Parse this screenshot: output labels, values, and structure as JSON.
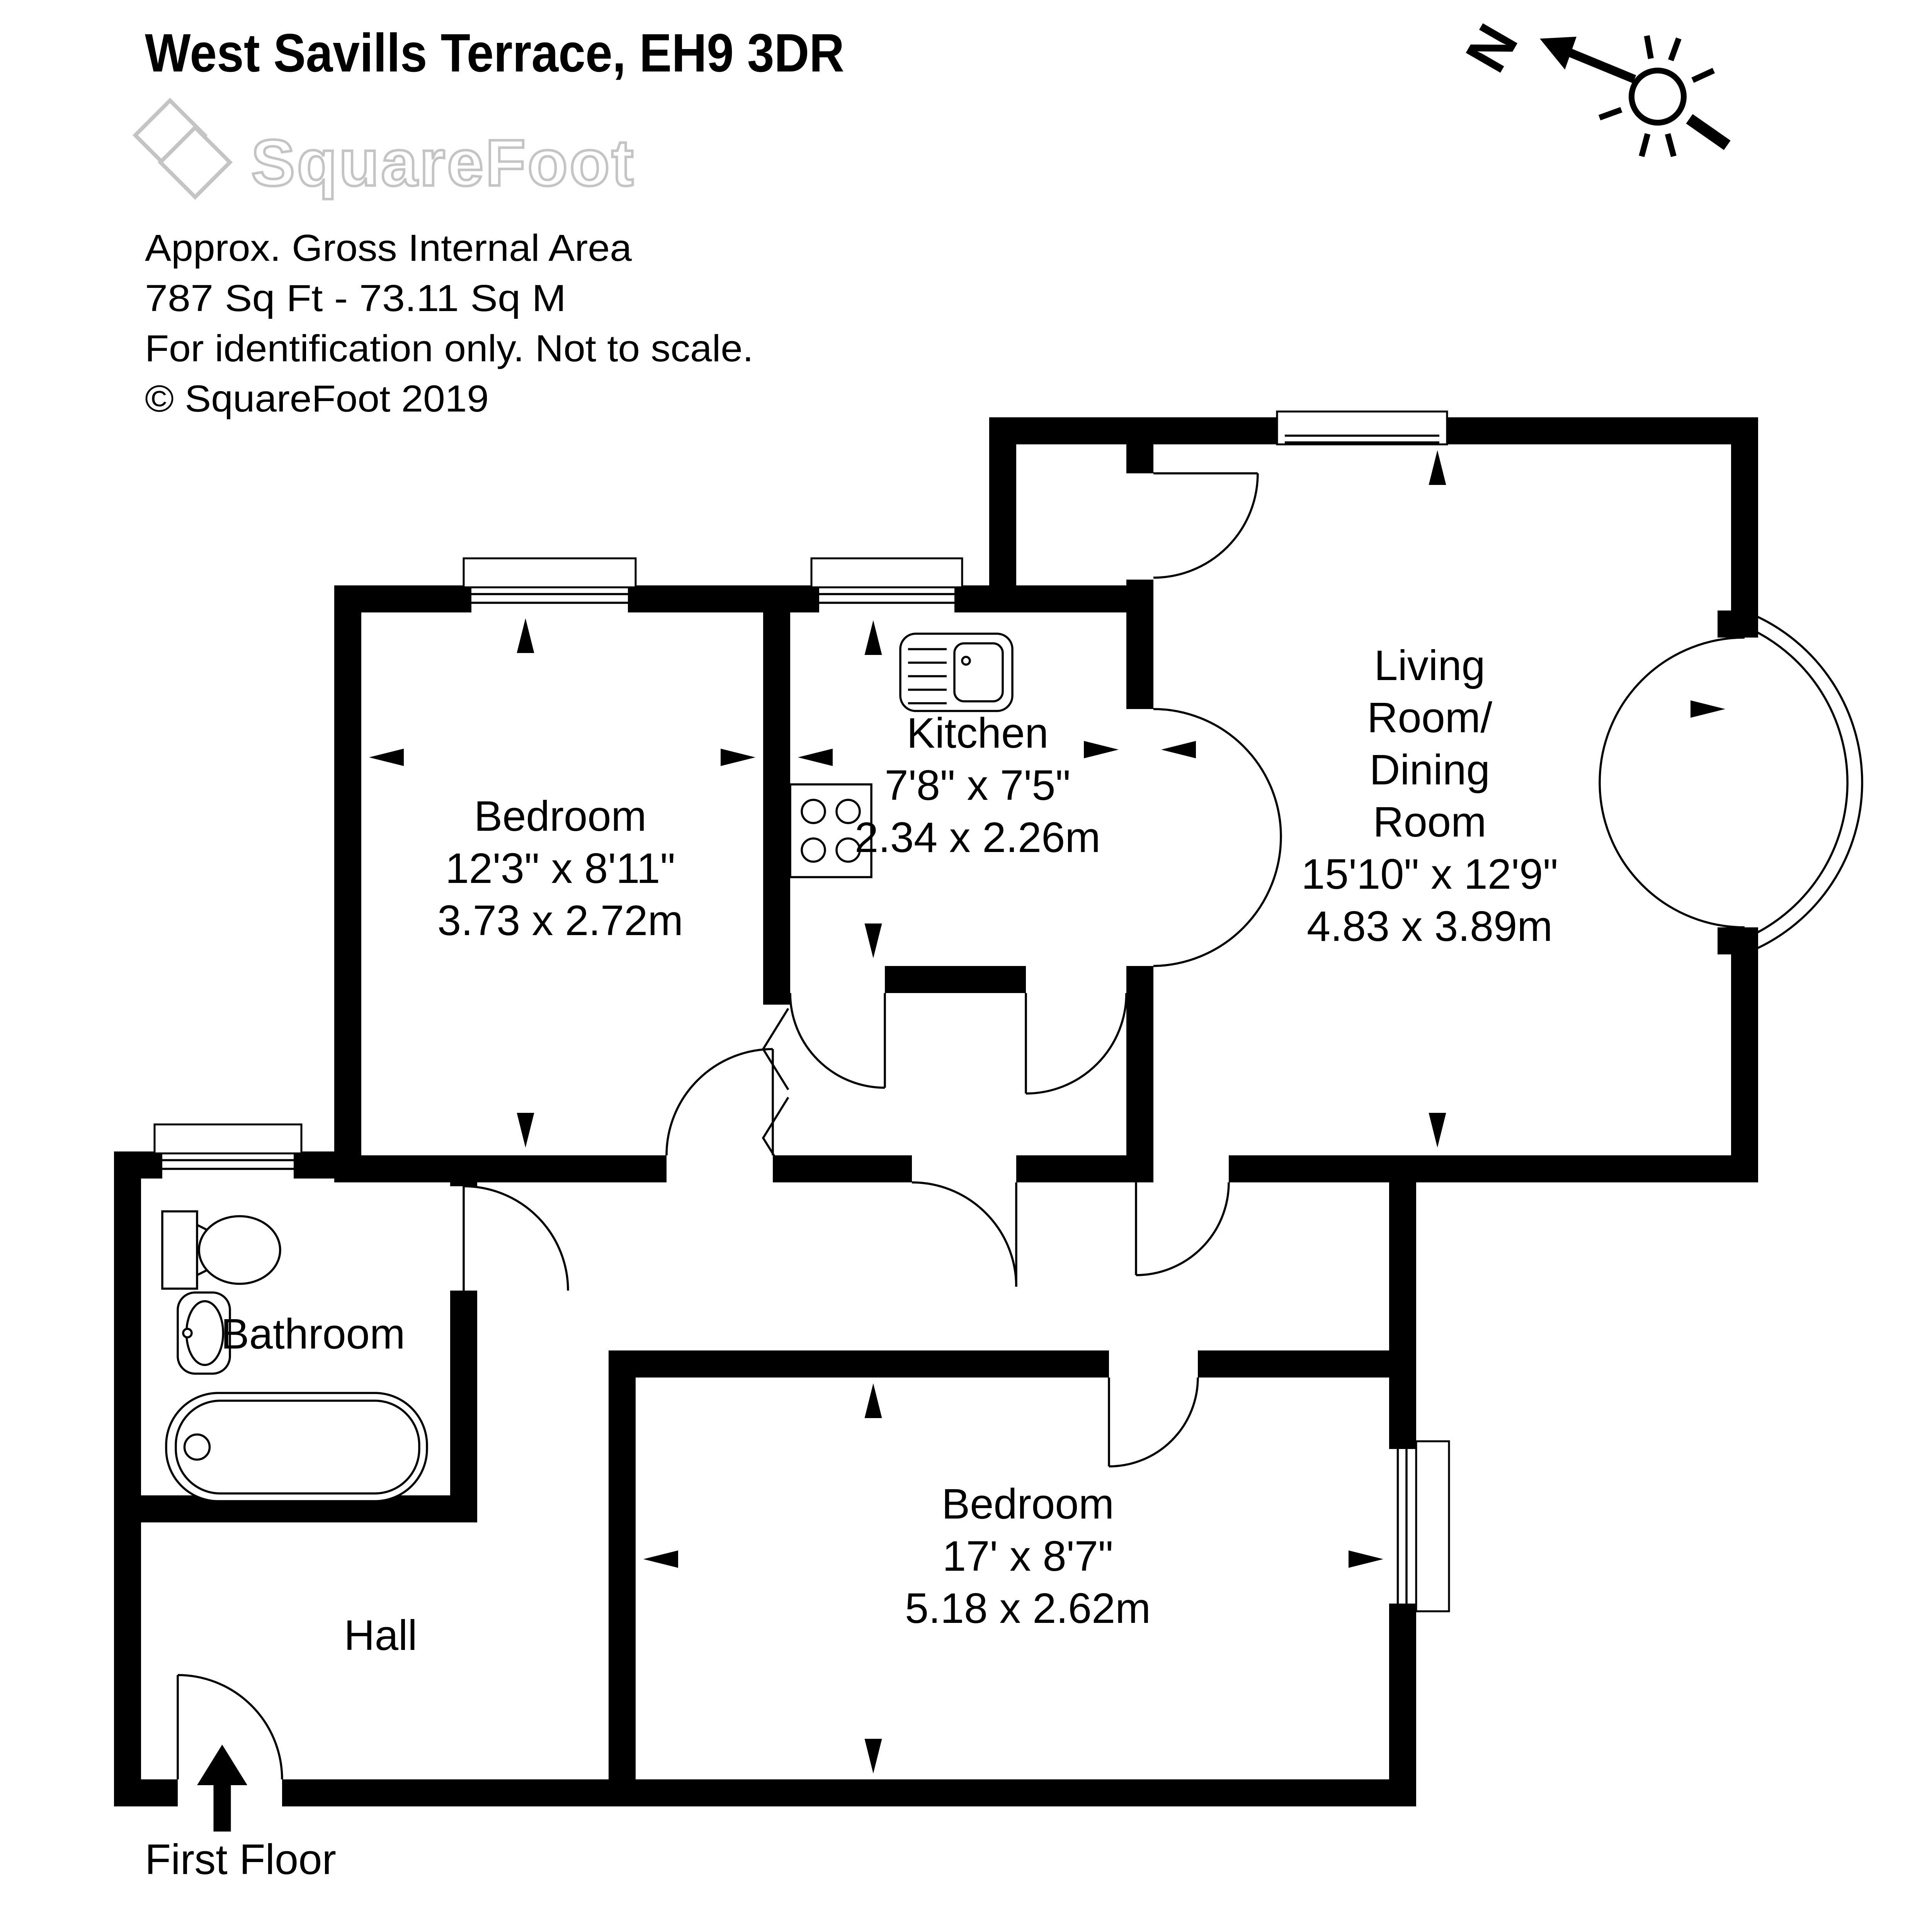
{
  "header": {
    "title": "West Savills Terrace, EH9 3DR",
    "logo_text": "SquareFoot",
    "area_line1": "Approx. Gross Internal Area",
    "area_line2": "787 Sq Ft  -  73.11 Sq M",
    "area_line3": "For identification only. Not to scale.",
    "copyright": "© SquareFoot 2019"
  },
  "compass": {
    "north_label": "N"
  },
  "rooms": {
    "bedroom1": {
      "name": "Bedroom",
      "imperial": "12'3\" x 8'11\"",
      "metric": "3.73 x 2.72m"
    },
    "kitchen": {
      "name": "Kitchen",
      "imperial": "7'8\" x 7'5\"",
      "metric": "2.34 x 2.26m"
    },
    "living": {
      "line1": "Living",
      "line2": "Room/",
      "line3": "Dining",
      "line4": "Room",
      "imperial": "15'10\" x 12'9\"",
      "metric": "4.83 x 3.89m"
    },
    "bedroom2": {
      "name": "Bedroom",
      "imperial": "17' x 8'7\"",
      "metric": "5.18 x 2.62m"
    },
    "bathroom": {
      "name": "Bathroom"
    },
    "hall": {
      "name": "Hall"
    }
  },
  "footer": {
    "floor_label": "First Floor"
  },
  "colors": {
    "wall": "#000000",
    "logo_outline": "#c4c4c4"
  }
}
